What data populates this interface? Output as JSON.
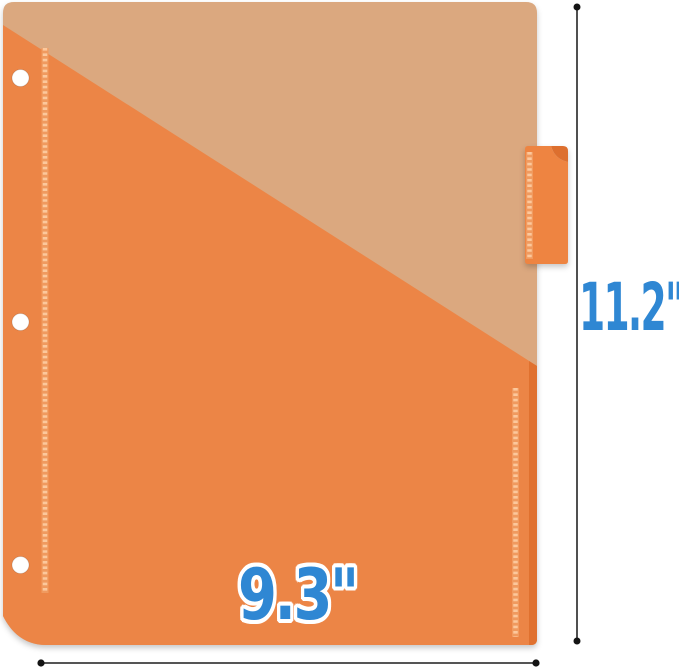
{
  "figure": {
    "height_label": "11.2\"",
    "width_label": "9.3\""
  },
  "colors": {
    "background": "#ffffff",
    "sheet_tan": "#dba87f",
    "pocket_orange": "#ec8546",
    "pocket_edge_dark": "#e0712f",
    "stitch_band": "#f09a5f",
    "stitch_dash": "#fcc89c",
    "tab_orange": "#ee8441",
    "tab_curl_dark": "#dd6f2e",
    "hole_white": "#ffffff",
    "dimension_line": "#3d3d3d",
    "dimension_dot": "#141414",
    "label_blue": "#2f87d3"
  }
}
